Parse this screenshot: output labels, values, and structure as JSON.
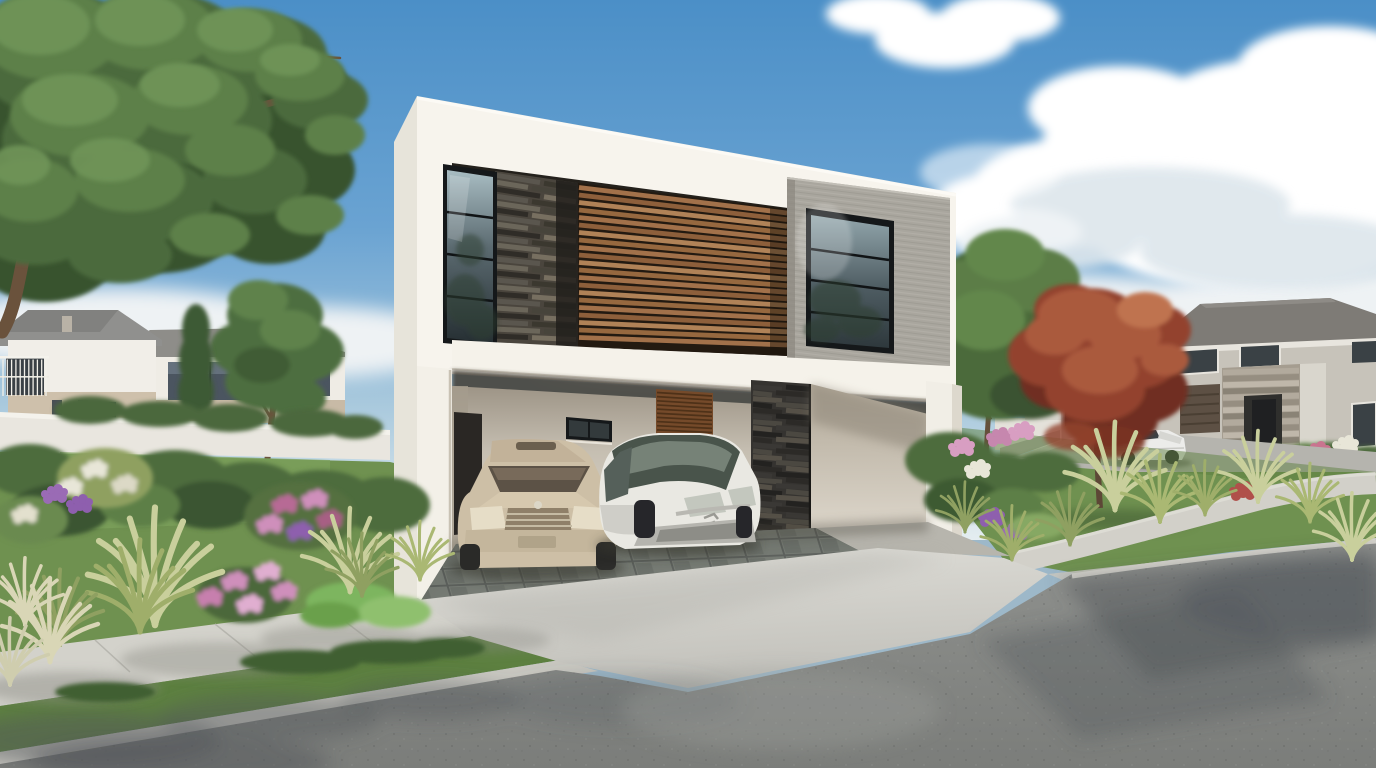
{
  "scene": {
    "type": "architectural-exterior-3d-rendering",
    "subject": "modern two-story white house with open double carport, two parked cars, landscaped corner lot in suburban neighborhood",
    "objects": [
      "sky",
      "clouds",
      "large-shade-tree",
      "neighbor-house-left",
      "neighbor-house-left-rear",
      "perimeter-wall",
      "conifer",
      "garden-tree",
      "red-leaf-shrub",
      "modern-house",
      "stone-clad-panel",
      "wood-slat-screen",
      "concrete-frame-volume",
      "upper-window-left",
      "upper-window-right",
      "floor-slab-fascia",
      "carport",
      "carport-back-window",
      "wood-louver-door",
      "dark-stone-pillar",
      "entry-wall",
      "champagne-sedan",
      "white-minivan",
      "slate-carport-floor",
      "driveway-apron",
      "sidewalk",
      "grass-strip",
      "curb",
      "asphalt-street",
      "neighbor-house-right",
      "stone-portico",
      "garage-door",
      "white-convertible",
      "red-maple-tree",
      "green-tree",
      "front-lawn",
      "flower-beds",
      "ornamental-grasses"
    ]
  },
  "palette": {
    "sky_top": "#4b8fc7",
    "sky_mid": "#6aa3d2",
    "sky_low": "#a9c9dd",
    "sky_horizon": "#e4edf0",
    "cloud": "#ffffff",
    "cloud_shade": "#dde6ec",
    "house_white": "#f7f4ed",
    "house_side": "#e7e4da",
    "fascia": "#f5f2ea",
    "column_white": "#f3f0e8",
    "recess_dark": "#24211c",
    "stone_panel": "#4a453d",
    "wood_dark": "#231a11",
    "wood_slat": "#a2714a",
    "concrete_volume": "#a9a69e",
    "frame_dark": "#15181a",
    "carport_wall_light": "#ddd7cb",
    "carport_wall_dark": "#9d9486",
    "pillar_stone": "#353330",
    "entry_wall": "#d9d2c6",
    "louver_wood": "#754a2a",
    "doorway_dark": "#2a2724",
    "slate_floor": "#6b6f6b",
    "interior_floor": "#b7b5ad",
    "driveway": "#d6d5cf",
    "sidewalk": "#d3d2cb",
    "curb": "#c9c8c1",
    "asphalt": "#878986",
    "asphalt_shadow": "#51565a",
    "lawn": "#6f9150",
    "grass_strip": "#5d8040",
    "shrub_green": "#4e6c3c",
    "shrub_dark": "#3a5530",
    "tree_green_mid": "#4c6b3e",
    "tree_green_light": "#5d8049",
    "branch_brown": "#6a523c",
    "flower_pink": "#cf8fbb",
    "flower_purple": "#8e5fae",
    "flower_white": "#e8e6d8",
    "flower_red": "#b0504a",
    "grass_tuft_cream": "#c9cf9c",
    "grass_tuft_green": "#8fa061",
    "red_tree_mid": "#93432f",
    "red_tree_light": "#aa5a3d",
    "red_tree_dark": "#6f2f22",
    "neighbor_wall": "#efece5",
    "neighbor_roof": "#8e8d89",
    "neighbor_band": "#cec0ab",
    "window_dark": "#3a4145",
    "right_house_wall": "#c7c3ba",
    "right_house_roof": "#7e7b76",
    "portico_stone": "#a59d90",
    "garage_door": "#5d5044",
    "car_champagne": "#cdbfa6",
    "car_champagne_dark": "#a8977e",
    "car_white": "#e9e8e2",
    "glass_tint": "#49544b"
  },
  "cars": [
    {
      "name": "champagne-sedan",
      "body_color": "#cdbfa6",
      "location": "carport-left"
    },
    {
      "name": "white-minivan",
      "body_color": "#e9e8e2",
      "location": "carport-right"
    },
    {
      "name": "white-convertible",
      "body_color": "#ececea",
      "location": "street-right"
    }
  ],
  "generated": {
    "wood_slats": {
      "count": 21,
      "colors": [
        "#a2714a",
        "#8d5f3b",
        "#b08257",
        "#96683f"
      ],
      "width": 4.8
    },
    "louver_slats": {
      "count": 11,
      "color": "#4e3118",
      "width": 1.7
    },
    "stone_courses": {
      "count": 24,
      "colors": [
        "#5a564e",
        "#3b382f",
        "#6b665a",
        "#47443b",
        "#2f2c27",
        "#776f60"
      ],
      "width": 5.0
    },
    "pillar_courses": {
      "count": 28,
      "colors": [
        "#3a3835",
        "#232220",
        "#4b4841",
        "#2c2a27",
        "#555047"
      ],
      "width": 5.0
    },
    "portico_courses": {
      "count": 13,
      "colors": [
        "#b2aa9d",
        "#968e81",
        "#bfb7aa",
        "#8a8376"
      ],
      "width": 5.6
    },
    "rail_posts": {
      "count": 11,
      "color": "#f2f0e9",
      "width": 1.3
    },
    "garage_lines": {
      "count": 4,
      "color": "#4a3f33",
      "width": 2
    }
  }
}
